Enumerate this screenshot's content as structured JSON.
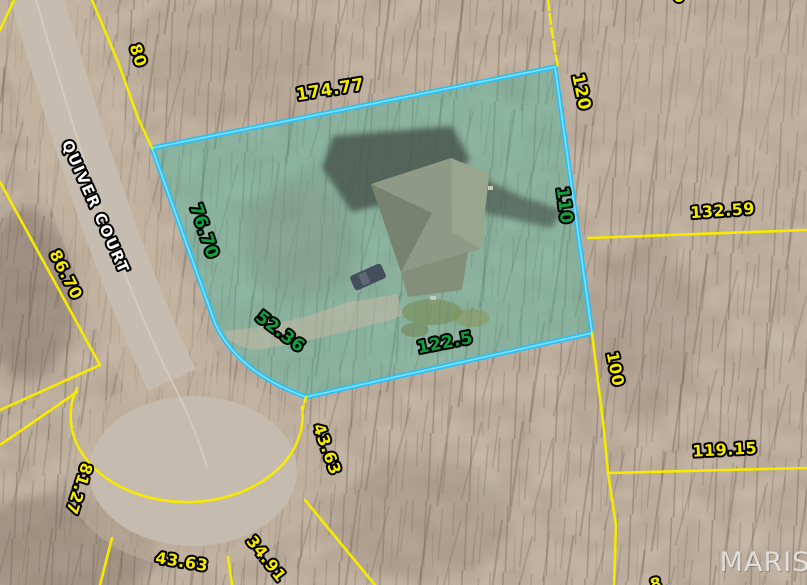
{
  "map_view": {
    "street_name": "QUIVER COURT",
    "watermark": "MARIS",
    "selected_parcel": {
      "side_north": "174.77",
      "side_east": "110",
      "side_south": "122.5",
      "side_west": "76.70",
      "side_curve_sw": "52.36"
    },
    "adjacent_lot_dimensions": {
      "road_frontage_nw": "80",
      "lot_line_ne": "120",
      "lot_line_e": "132.59",
      "lot_line_w": "86.70",
      "lot_line_s_vertical": "100",
      "lot_line_s_horizontal": "119.15",
      "culdesac_arc_e": "43.63",
      "culdesac_arc_se": "34.91",
      "culdesac_arc_s": "43.63",
      "culdesac_arc_w": "81.27",
      "partial_label_top": "0",
      "partial_label_bottom": "8"
    },
    "colors": {
      "lot_line": "#f6ea00",
      "lot_dimension_text": "#f6ea00",
      "selected_outline": "#2fc0f2",
      "selected_outline_core": "#8fe6ff",
      "selected_fill": "rgba(62,182,158,0.40)",
      "selected_dimension_text": "#0da33c",
      "street_text": "#ffffff",
      "watermark_text": "#e9e9e9"
    }
  }
}
